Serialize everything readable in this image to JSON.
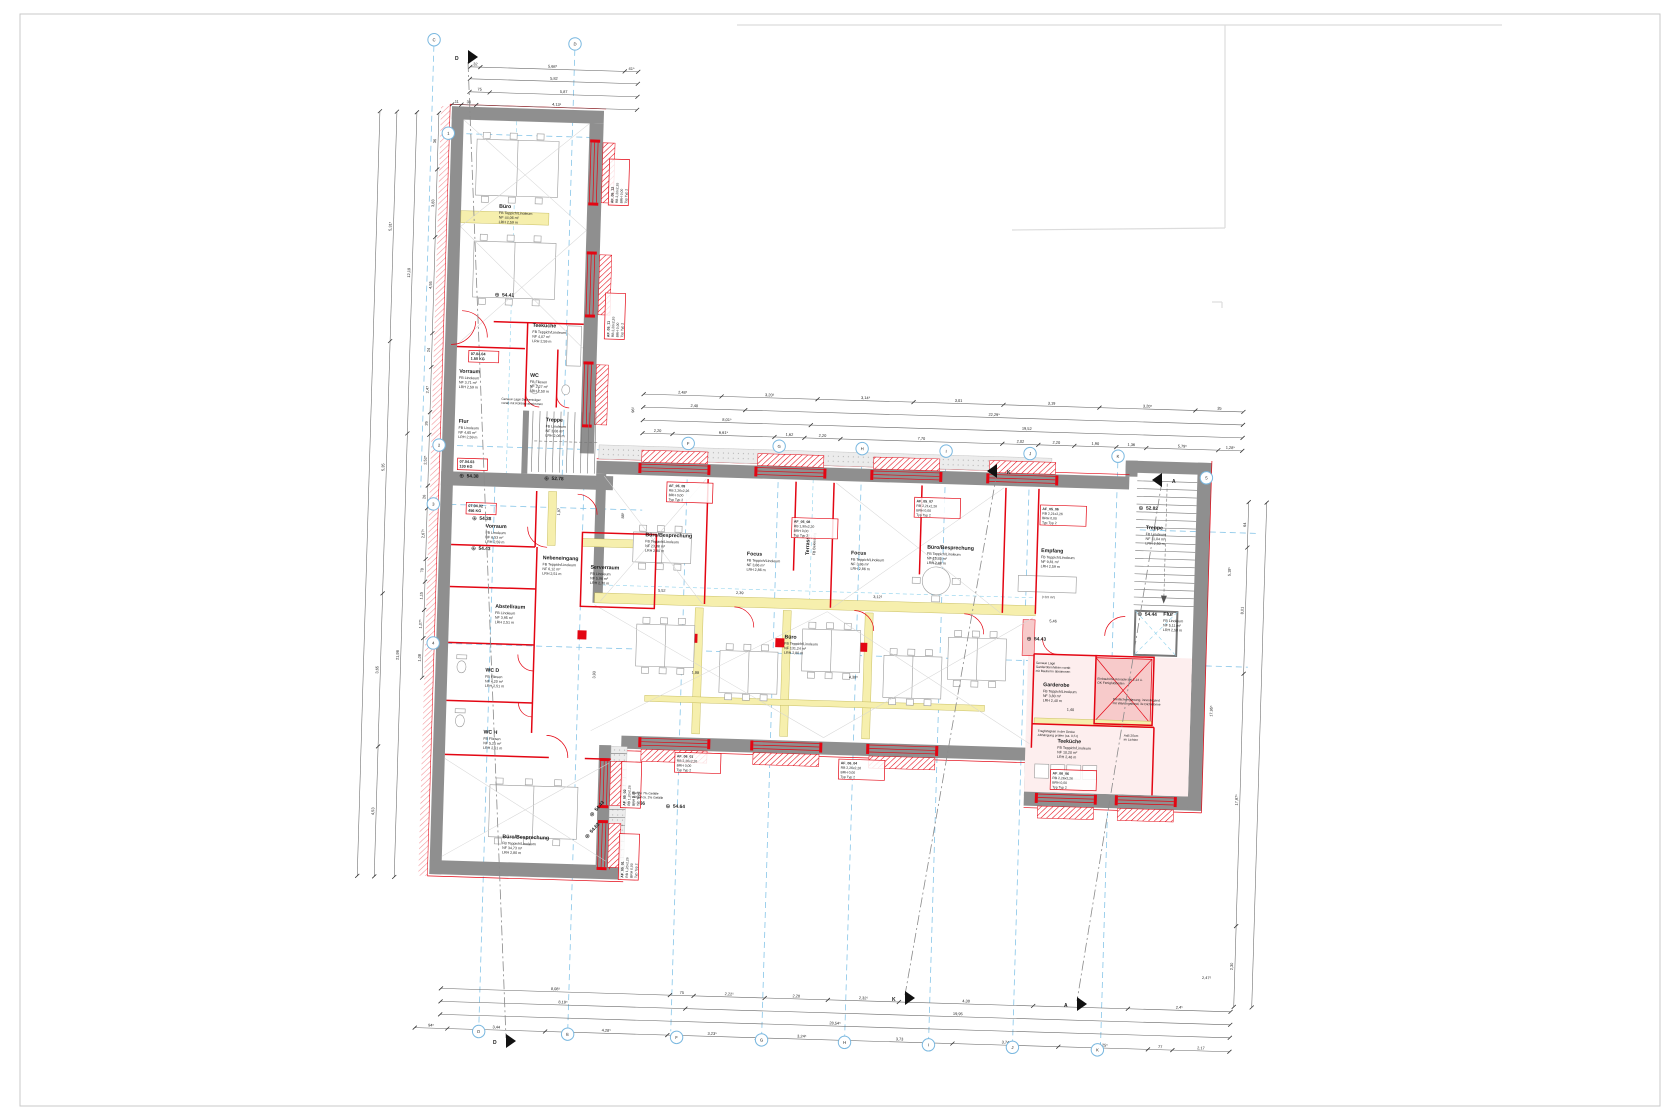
{
  "symbols": {
    "level": "⊕"
  },
  "rooms": [
    {
      "name": "Büro",
      "info": [
        "FB  Teppich/Linoleum",
        "NF  44,06 m²",
        "LRH  2,59 m"
      ],
      "x": 490,
      "y": 218
    },
    {
      "name": "Teeküche",
      "info": [
        "FB  Teppich/Linoleum",
        "NF  4,07 m²",
        "LRH  2,59 m"
      ],
      "x": 527,
      "y": 336
    },
    {
      "name": "Vorraum",
      "info": [
        "FB  Linoleum",
        "NF  3,71 m²",
        "LRH  2,59 m"
      ],
      "x": 455,
      "y": 384
    },
    {
      "name": "WC",
      "info": [
        "FB  Fliesen",
        "NF  2,27 m²",
        "LRH  2,50 m"
      ],
      "x": 526,
      "y": 386
    },
    {
      "name": "Flur",
      "info": [
        "FB  Linoleum",
        "NF  4,65 m²",
        "LRH  2,59 m"
      ],
      "x": 456,
      "y": 434
    },
    {
      "name": "Treppe",
      "info": [
        "FB  Linoleum",
        "NF  3,06 m²",
        "LRH  2,06 m"
      ],
      "x": 543,
      "y": 430
    },
    {
      "name": "Vorraum",
      "info": [
        "FB  Linoleum",
        "NF  6,53 m²",
        "LRH  2,59 m"
      ],
      "x": 486,
      "y": 538
    },
    {
      "name": "Nebeneingang",
      "info": [
        "FB  Teppich/Linoleum",
        "NF  6,12 m²",
        "LRH  2,51 m"
      ],
      "x": 544,
      "y": 568
    },
    {
      "name": "Serverraum",
      "info": [
        "FB  Linoleum",
        "NF  5,96 m²",
        "LRH  2,70 m"
      ],
      "x": 592,
      "y": 576
    },
    {
      "name": "Abstellraum",
      "info": [
        "FB  Linoleum",
        "NF  3,95 m²",
        "LRH  2,51 m"
      ],
      "x": 498,
      "y": 618
    },
    {
      "name": "WC D",
      "info": [
        "FB  Fliesen",
        "NF  4,20 m²",
        "LRH  2,51 m"
      ],
      "x": 490,
      "y": 682
    },
    {
      "name": "WC H",
      "info": [
        "FB  Fliesen",
        "NF  5,25 m²",
        "LRH  2,51 m"
      ],
      "x": 490,
      "y": 744
    },
    {
      "name": "Büro/Besprechung",
      "info": [
        "FB  Teppich/Linoleum",
        "NF  34,73 m²",
        "LRH  2,80 m"
      ],
      "x": 512,
      "y": 848
    },
    {
      "name": "Büro/Besprechung",
      "info": [
        "FB  Teppich/Linoleum",
        "NF  23,88 m²",
        "LRH  2,80 m"
      ],
      "x": 646,
      "y": 542
    },
    {
      "name": "Focus",
      "info": [
        "FB  Teppich/Linoleum",
        "NF  3,86 m²",
        "LRH  2,86 m"
      ],
      "x": 748,
      "y": 558
    },
    {
      "name": "Focus",
      "info": [
        "FB  Teppich/Linoleum",
        "NF  3,86 m²",
        "LRH  2,86 m"
      ],
      "x": 852,
      "y": 554
    },
    {
      "name": "Büro/Besprechung",
      "info": [
        "FB  Teppich/Linoleum",
        "NF  15,43 m²",
        "LRH  2,80 m"
      ],
      "x": 928,
      "y": 546
    },
    {
      "name": "Empfang",
      "info": [
        "FB  Teppich/Linoleum",
        "NF  9,81 m²",
        "LRH  2,59 m"
      ],
      "x": 1042,
      "y": 546
    },
    {
      "name": "Büro",
      "info": [
        "FB  Teppich/Linoleum",
        "NF  131,24 m²",
        "LRH  2,80 m"
      ],
      "x": 788,
      "y": 640
    },
    {
      "name": "Garderobe",
      "info": [
        "FB  Teppich/Linoleum",
        "NF  3,80 m²",
        "LRH  2,40 m"
      ],
      "x": 1048,
      "y": 680
    },
    {
      "name": "Teeküche",
      "info": [
        "FB  Teppich/Linoleum",
        "NF  10,20 m²",
        "LRH  2,46 m"
      ],
      "x": 1064,
      "y": 736
    },
    {
      "name": "Treppe",
      "info": [
        "FB  Linoleum",
        "NF  11,04 m²",
        "LRH  2,50 m"
      ],
      "x": 1146,
      "y": 520
    },
    {
      "name": "Flur",
      "info": [
        "FB  Linoleum",
        "NF  5,11 m²",
        "LRH  2,50 m"
      ],
      "x": 1166,
      "y": 606
    },
    {
      "name": "Terrasse",
      "info": [
        "FB  Bekiesung"
      ],
      "x": 810,
      "y": 556,
      "rot": -90
    }
  ],
  "levels": [
    {
      "v": "54.41",
      "x": 488,
      "y": 306
    },
    {
      "v": "54.38",
      "x": 458,
      "y": 488
    },
    {
      "v": "52.78",
      "x": 543,
      "y": 488
    },
    {
      "v": "54.38",
      "x": 472,
      "y": 530
    },
    {
      "v": "54.43",
      "x": 472,
      "y": 560
    },
    {
      "v": "54.43",
      "x": 1030,
      "y": 634
    },
    {
      "v": "52.82",
      "x": 1138,
      "y": 500
    },
    {
      "v": "54.44",
      "x": 1140,
      "y": 606
    },
    {
      "v": "54.66",
      "x": 634,
      "y": 810
    },
    {
      "v": "54.64",
      "x": 674,
      "y": 812
    },
    {
      "v": "54.43",
      "x": 600,
      "y": 824,
      "rot": -50
    },
    {
      "v": "54.63",
      "x": 596,
      "y": 846,
      "rot": -50
    }
  ],
  "tags": [
    {
      "id": "AF_05_12",
      "rb": "RB  2,26x2,26",
      "brh": "BRH  0,00",
      "typ": "Typ  Typ 2",
      "x": 604,
      "y": 210,
      "rot": -90
    },
    {
      "id": "AF_05_11",
      "rb": "RB  2,26x2,26",
      "brh": "BRH  0,00",
      "typ": "Typ  Typ 2",
      "x": 604,
      "y": 344,
      "rot": -90
    },
    {
      "id": "AF_05_09",
      "rb": "RB  2,26x2,26",
      "brh": "BRH  0,00",
      "typ": "Typ  Typ 2",
      "x": 668,
      "y": 492
    },
    {
      "id": "AF_05_08",
      "rb": "RB  1,90x2,20",
      "brh": "BRH  0,00",
      "typ": "Typ  Typ 2",
      "x": 794,
      "y": 524
    },
    {
      "id": "AF_05_07",
      "rb": "RB  2,21x2,26",
      "brh": "BRH  0,00",
      "typ": "Typ  Typ 2",
      "x": 916,
      "y": 500
    },
    {
      "id": "AF_05_06",
      "rb": "RB  2,21x2,26",
      "brh": "BRH  0,00",
      "typ": "Typ  Typ 2",
      "x": 1042,
      "y": 504
    },
    {
      "id": "AF_06_01",
      "rb": "RB  2,26x2,26",
      "brh": "BRH  0,00",
      "typ": "Typ  Typ 2",
      "x": 684,
      "y": 762
    },
    {
      "id": "AF_06_04",
      "rb": "RB  2,26x2,26",
      "brh": "BRH  0,00",
      "typ": "Typ  Typ 2",
      "x": 848,
      "y": 764
    },
    {
      "id": "AF_06_06",
      "rb": "RB  2,26x2,26",
      "brh": "BRH  0,00",
      "typ": "Typ  Typ 2",
      "x": 1060,
      "y": 768
    },
    {
      "id": "AF_05_02",
      "rb": "RB  1,26x2,26",
      "brh": "BRH  0,00",
      "typ": "Typ  Typ 2",
      "x": 634,
      "y": 812,
      "rot": -90
    },
    {
      "id": "AF_05_01",
      "rb": "RB  1,26x2,26",
      "brh": "BRH  0,00",
      "typ": "Typ  Typ 2",
      "x": 634,
      "y": 884,
      "rot": -90
    }
  ],
  "red_tags": [
    {
      "l1": "07.04.04",
      "l2": "1.50 KG",
      "x": 466,
      "y": 366
    },
    {
      "l1": "07.04.03",
      "l2": "130 KG",
      "x": 458,
      "y": 474
    },
    {
      "l1": "07.04.02",
      "l2": "456 KG",
      "x": 468,
      "y": 518
    }
  ],
  "notes": [
    {
      "lines": [
        "Genaue Lage Deckenträger",
        "vorab mit Rohbau abstimmen"
      ],
      "x": 498,
      "y": 410
    },
    {
      "lines": [
        "Genaue Lage",
        "Garderobenhaken vorab",
        "mit Bauherrn abstimmen"
      ],
      "x": 1040,
      "y": 658
    },
    {
      "lines": [
        "Einbauhöhe Konsole bei 2,14 ü.",
        "OK Fertigfußboden"
      ],
      "x": 1102,
      "y": 672
    },
    {
      "lines": [
        "Tragfähigkeit in der Decke",
        "Abhängung prüfen (ca. 0,5 t)"
      ],
      "x": 1044,
      "y": 726
    },
    {
      "lines": [
        "AxB 20cm",
        "im Lichten"
      ],
      "x": 1130,
      "y": 728
    },
    {
      "lines": [
        "Dreifachverglasung, innenliegend",
        "mit Wartungsband, 3x Dichtebene"
      ],
      "x": 1118,
      "y": 692
    },
    {
      "lines": [
        "Rampe 7% Gefälle",
        "Verlauf ca. 2% Gefälle"
      ],
      "x": 640,
      "y": 800
    },
    {
      "lines": [
        "(+0,5 m²)"
      ],
      "x": 1044,
      "y": 592
    }
  ],
  "dims": {
    "chains": [
      {
        "x1": 457,
        "y1": 78,
        "x2": 625,
        "y2": 78,
        "parts": [
          [
            0.06,
            "32"
          ],
          [
            0.86,
            "5,68⁵"
          ],
          [
            0.08,
            "41⁵"
          ]
        ]
      },
      {
        "x1": 457,
        "y1": 90,
        "x2": 625,
        "y2": 90,
        "parts": [
          [
            1,
            "5,82"
          ]
        ]
      },
      {
        "x1": 457,
        "y1": 103,
        "x2": 625,
        "y2": 103,
        "parts": [
          [
            0.12,
            "75"
          ],
          [
            0.88,
            "5,87"
          ]
        ]
      },
      {
        "x1": 440,
        "y1": 116,
        "x2": 625,
        "y2": 116,
        "parts": [
          [
            0.05,
            "11"
          ],
          [
            0.08,
            "36"
          ],
          [
            0.87,
            "4,13⁵"
          ]
        ]
      },
      {
        "x1": 640,
        "y1": 400,
        "x2": 1240,
        "y2": 400,
        "parts": [
          [
            0.13,
            "2,48⁵"
          ],
          [
            0.16,
            "3,20⁵"
          ],
          [
            0.16,
            "3,14⁵"
          ],
          [
            0.15,
            "3,01"
          ],
          [
            0.16,
            "3,19"
          ],
          [
            0.16,
            "3,20⁵"
          ],
          [
            0.08,
            "35"
          ]
        ]
      },
      {
        "x1": 640,
        "y1": 413,
        "x2": 1240,
        "y2": 413,
        "parts": [
          [
            0.17,
            "2,40"
          ],
          [
            0.83,
            "22,29⁵"
          ]
        ]
      },
      {
        "x1": 640,
        "y1": 426,
        "x2": 1240,
        "y2": 426,
        "parts": [
          [
            0.28,
            "8,01⁵"
          ],
          [
            0.72,
            "19,52"
          ]
        ]
      },
      {
        "x1": 640,
        "y1": 439,
        "x2": 1240,
        "y2": 439,
        "parts": [
          [
            0.05,
            "2,20"
          ],
          [
            0.17,
            "6,61⁵"
          ],
          [
            0.05,
            "1,62"
          ],
          [
            0.06,
            "2,20"
          ],
          [
            0.27,
            "7,70"
          ],
          [
            0.06,
            "2,02"
          ],
          [
            0.06,
            "2,20"
          ],
          [
            0.07,
            "1,90"
          ],
          [
            0.05,
            "1,36"
          ],
          [
            0.12,
            "5,79⁵"
          ],
          [
            0.04,
            "1,28⁵"
          ]
        ]
      },
      {
        "x1": 455,
        "y1": 1000,
        "x2": 1245,
        "y2": 1000,
        "parts": [
          [
            0.29,
            "8,08⁵"
          ],
          [
            0.03,
            "75"
          ],
          [
            0.09,
            "2,22⁵"
          ],
          [
            0.08,
            "2,20"
          ],
          [
            0.09,
            "2,32⁵"
          ],
          [
            0.17,
            "4,30"
          ],
          [
            0.12,
            "2,32"
          ],
          [
            0.13,
            "2,4⁵"
          ]
        ]
      },
      {
        "x1": 455,
        "y1": 1013,
        "x2": 1245,
        "y2": 1013,
        "parts": [
          [
            0.31,
            "8,19⁵"
          ],
          [
            0.69,
            "19,95"
          ]
        ]
      },
      {
        "x1": 455,
        "y1": 1026,
        "x2": 1245,
        "y2": 1026,
        "parts": [
          [
            1,
            "28,54⁵"
          ]
        ]
      },
      {
        "x1": 430,
        "y1": 1040,
        "x2": 1245,
        "y2": 1040,
        "parts": [
          [
            0.04,
            "94⁵"
          ],
          [
            0.12,
            "3,44"
          ],
          [
            0.15,
            "4,28⁵"
          ],
          [
            0.11,
            "3,23⁵"
          ],
          [
            0.11,
            "3,24⁵"
          ],
          [
            0.13,
            "3,73"
          ],
          [
            0.13,
            "3,74"
          ],
          [
            0.11,
            "3,25⁵"
          ],
          [
            0.03,
            "77"
          ],
          [
            0.07,
            "2,17"
          ]
        ]
      },
      {
        "x1": 427,
        "y1": 125,
        "x2": 427,
        "y2": 690,
        "parts": [
          [
            0.1,
            "36"
          ],
          [
            0.12,
            "3,83"
          ],
          [
            0.17,
            "4,55"
          ],
          [
            0.06,
            "24"
          ],
          [
            0.08,
            "2,47"
          ],
          [
            0.04,
            "26"
          ],
          [
            0.09,
            "2,52⁵"
          ],
          [
            0.04,
            "26"
          ],
          [
            0.09,
            "2,67⁵"
          ],
          [
            0.04,
            "78"
          ],
          [
            0.05,
            "1,15"
          ],
          [
            0.05,
            "1,07⁵"
          ],
          [
            0.07,
            "1,08"
          ]
        ]
      },
      {
        "x1": 405,
        "y1": 125,
        "x2": 405,
        "y2": 890,
        "parts": [
          [
            0.42,
            "12,19"
          ],
          [
            0.58,
            "21,98"
          ]
        ]
      },
      {
        "x1": 385,
        "y1": 125,
        "x2": 385,
        "y2": 890,
        "parts": [
          [
            0.3,
            "5,31⁵"
          ],
          [
            0.33,
            "5,35"
          ],
          [
            0.2,
            "3,65"
          ],
          [
            0.17,
            "4,53"
          ]
        ]
      },
      {
        "x1": 368,
        "y1": 125,
        "x2": 368,
        "y2": 890,
        "parts": [
          [
            1,
            ""
          ]
        ]
      },
      {
        "x1": 1248,
        "y1": 490,
        "x2": 1248,
        "y2": 995,
        "parts": [
          [
            0.09,
            "64"
          ],
          [
            0.25,
            "8,01"
          ],
          [
            0.5,
            "17,97⁵"
          ],
          [
            0.16,
            "2,30"
          ]
        ]
      },
      {
        "x1": 1266,
        "y1": 490,
        "x2": 1266,
        "y2": 995,
        "parts": [
          [
            1,
            ""
          ]
        ]
      }
    ],
    "free": [
      {
        "t": "5,52",
        "x": 664,
        "y": 597
      },
      {
        "t": "2,39",
        "x": 742,
        "y": 597
      },
      {
        "t": "3,12⁵",
        "x": 880,
        "y": 597
      },
      {
        "t": "5,46",
        "x": 1056,
        "y": 616
      },
      {
        "t": "1,40",
        "x": 1076,
        "y": 704
      },
      {
        "t": "1,88",
        "x": 700,
        "y": 678
      },
      {
        "t": "4,38⁵",
        "x": 858,
        "y": 678
      },
      {
        "t": "2,47⁵",
        "x": 1220,
        "y": 968
      },
      {
        "t": "96⁵",
        "x": 631,
        "y": 416,
        "rot": -90
      },
      {
        "t": "1,97",
        "x": 560,
        "y": 520,
        "rot": -90
      },
      {
        "t": "88⁵",
        "x": 624,
        "y": 522,
        "rot": -90
      },
      {
        "t": "3,93",
        "x": 600,
        "y": 682,
        "rot": -90
      },
      {
        "t": "17,95⁵",
        "x": 1218,
        "y": 700,
        "rot": -90
      },
      {
        "t": "5,18⁵",
        "x": 1232,
        "y": 560,
        "rot": -90
      }
    ]
  },
  "axes": {
    "bubbles": [
      {
        "l": "C",
        "x": 420,
        "y": 52
      },
      {
        "l": "D",
        "x": 561,
        "y": 52
      },
      {
        "l": "F",
        "x": 686,
        "y": 448
      },
      {
        "l": "G",
        "x": 777,
        "y": 448
      },
      {
        "l": "H",
        "x": 860,
        "y": 448
      },
      {
        "l": "I",
        "x": 944,
        "y": 448
      },
      {
        "l": "J",
        "x": 1028,
        "y": 448
      },
      {
        "l": "K",
        "x": 1116,
        "y": 448
      },
      {
        "l": "D",
        "x": 494,
        "y": 1042
      },
      {
        "l": "E",
        "x": 583,
        "y": 1042
      },
      {
        "l": "F",
        "x": 692,
        "y": 1042
      },
      {
        "l": "G",
        "x": 777,
        "y": 1042
      },
      {
        "l": "H",
        "x": 860,
        "y": 1042
      },
      {
        "l": "I",
        "x": 944,
        "y": 1042
      },
      {
        "l": "J",
        "x": 1028,
        "y": 1042
      },
      {
        "l": "K",
        "x": 1113,
        "y": 1042
      },
      {
        "l": "1",
        "x": 437,
        "y": 145
      },
      {
        "l": "2",
        "x": 437,
        "y": 457
      },
      {
        "l": "3",
        "x": 433,
        "y": 516
      },
      {
        "l": "4",
        "x": 437,
        "y": 655
      },
      {
        "l": "5",
        "x": 1205,
        "y": 467
      }
    ],
    "sections": [
      {
        "l": "D",
        "x": 468,
        "y": 57,
        "d": 1,
        "lx": 455,
        "ly": 60
      },
      {
        "l": "D",
        "x": 506,
        "y": 1041,
        "d": 1,
        "lx": 493,
        "ly": 1044
      },
      {
        "l": "K",
        "x": 997,
        "y": 471,
        "d": -1,
        "lx": 1007,
        "ly": 474
      },
      {
        "l": "K",
        "x": 905,
        "y": 998,
        "d": 1,
        "lx": 892,
        "ly": 1001
      },
      {
        "l": "A",
        "x": 1162,
        "y": 480,
        "d": -1,
        "lx": 1172,
        "ly": 483
      },
      {
        "l": "A",
        "x": 1077,
        "y": 1004,
        "d": 1,
        "lx": 1064,
        "ly": 1007
      }
    ]
  }
}
